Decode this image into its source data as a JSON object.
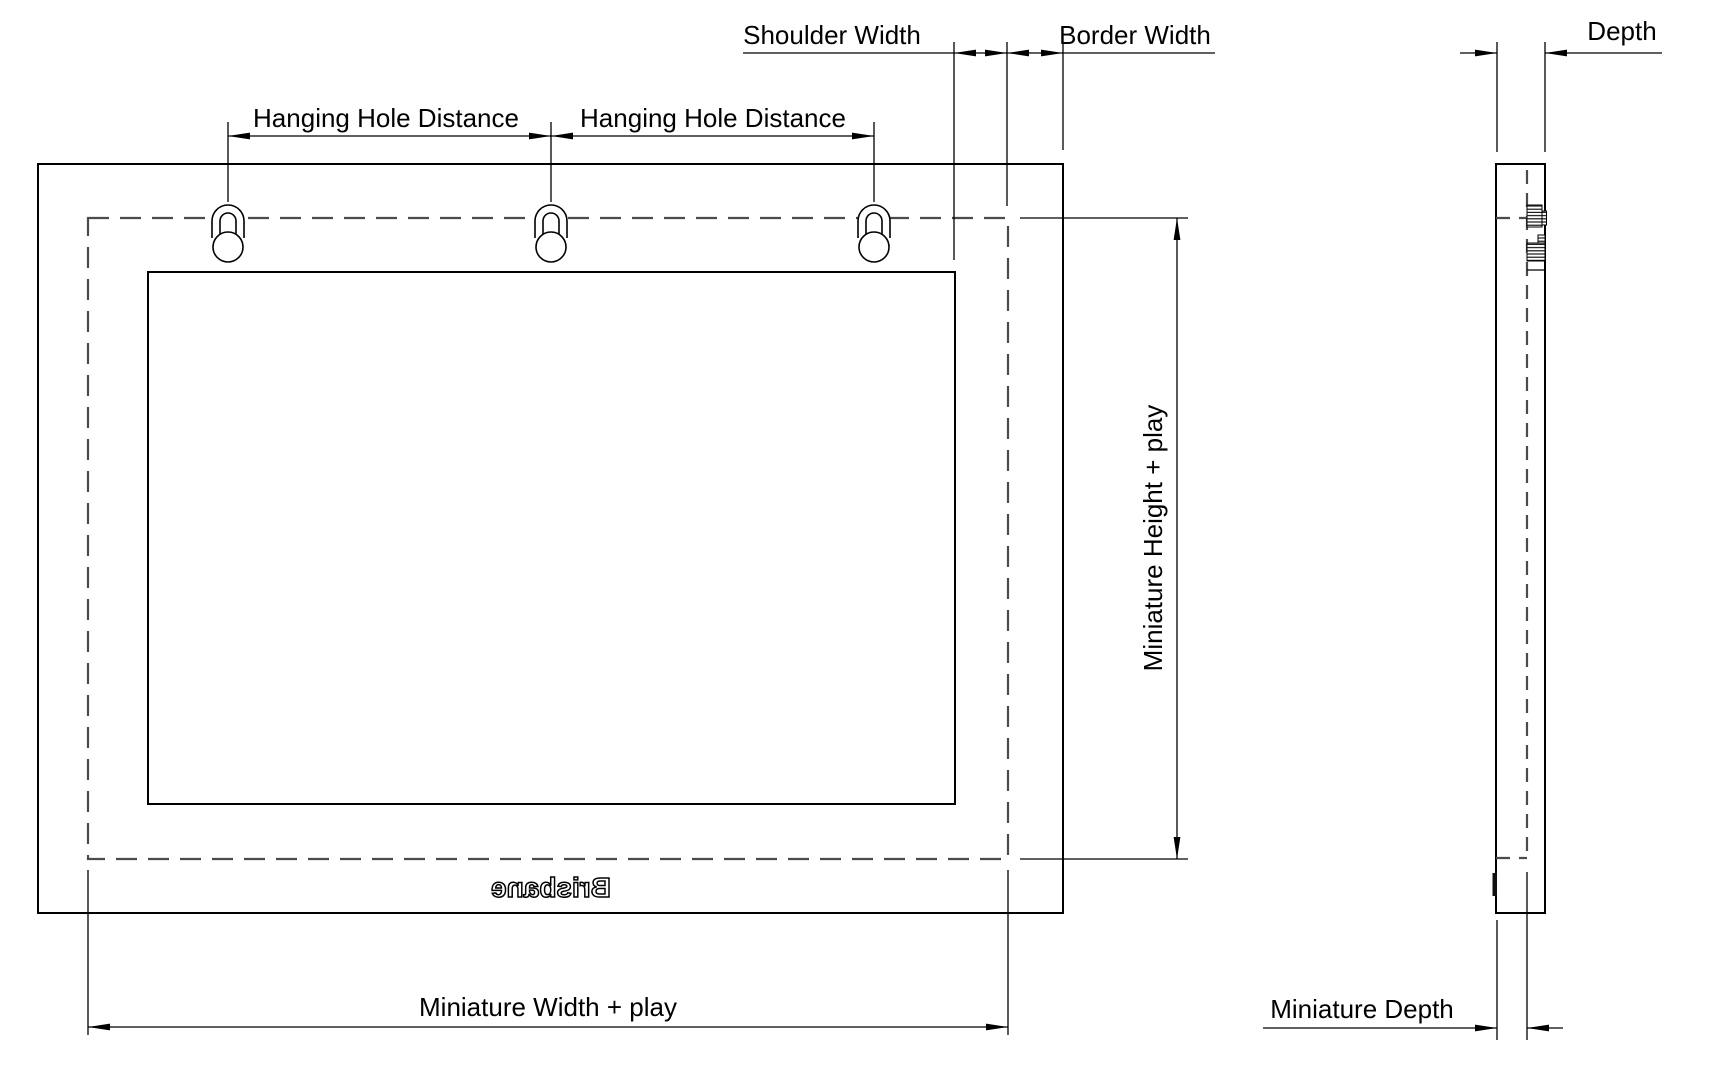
{
  "drawing": {
    "type": "technical-dimension-drawing",
    "views": [
      "front-view",
      "side-view"
    ],
    "colors": {
      "line": "#000000",
      "dashed_line": "#4b4b4b",
      "background": "#ffffff"
    },
    "labels": {
      "shoulder_width": "Shoulder Width",
      "border_width": "Border Width",
      "depth": "Depth",
      "hanging_hole_distance_left": "Hanging Hole Distance",
      "hanging_hole_distance_right": "Hanging Hole Distance",
      "miniature_height": "Miniature Height + play",
      "miniature_width": "Miniature Width + play",
      "miniature_depth": "Miniature Depth",
      "logo": "Brisbane"
    },
    "features": {
      "hanging_hole_count": 3,
      "logo_style": "mirrored outline emboss"
    }
  }
}
